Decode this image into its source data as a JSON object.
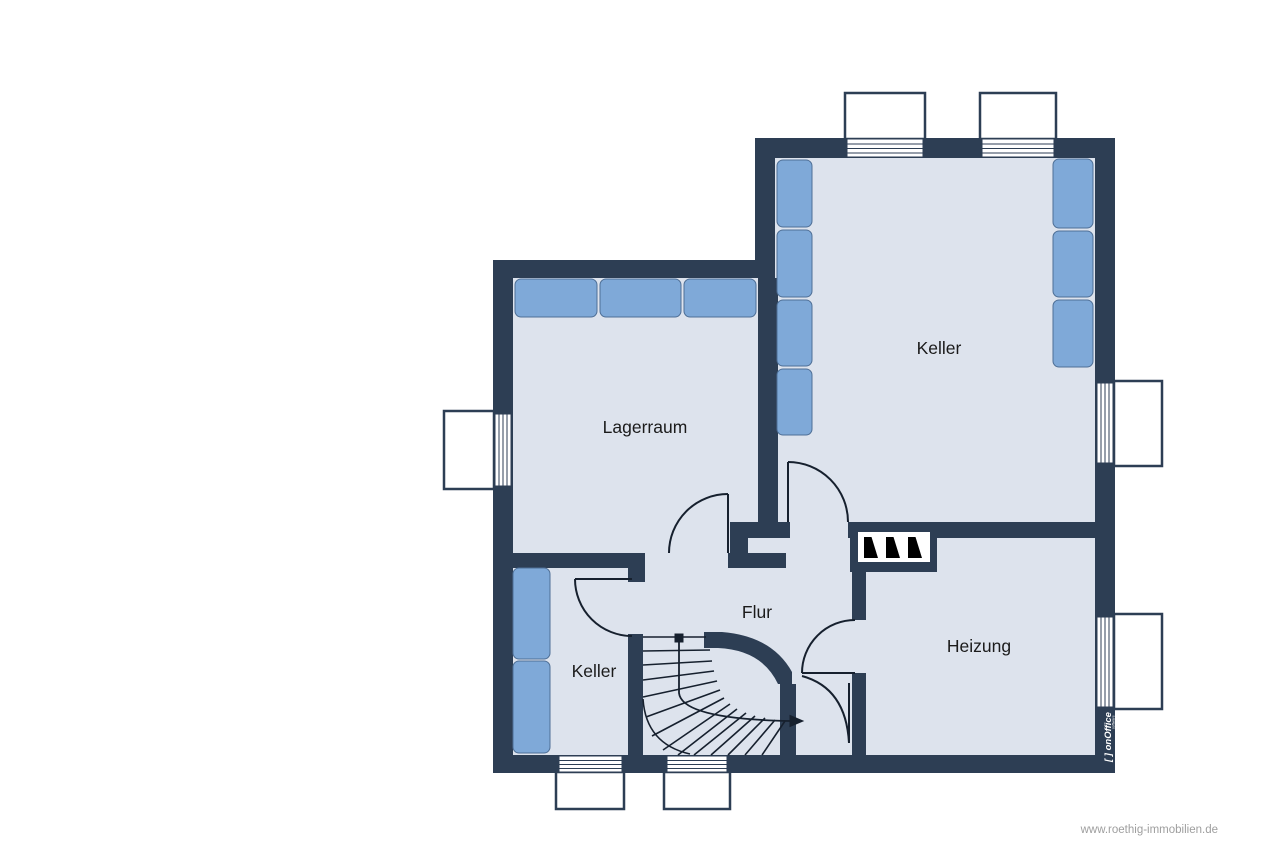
{
  "rooms": [
    {
      "label": "Keller"
    },
    {
      "label": "Lagerraum"
    },
    {
      "label": "Flur"
    },
    {
      "label": "Keller"
    },
    {
      "label": "Heizung"
    }
  ],
  "branding": {
    "logo_label": "[ ] onOffice",
    "logo_sub": "software"
  },
  "watermark": {
    "text": "www.roethig-immobilien.de"
  },
  "colors": {
    "wall": "#2d3e54",
    "floor": "#dde3ed",
    "furniture": "#7fa9d8",
    "line": "#16202e",
    "label_text": "#1b1b1b",
    "watermark_text": "#9e9e9e",
    "logo_text_color": "#ffffff"
  }
}
